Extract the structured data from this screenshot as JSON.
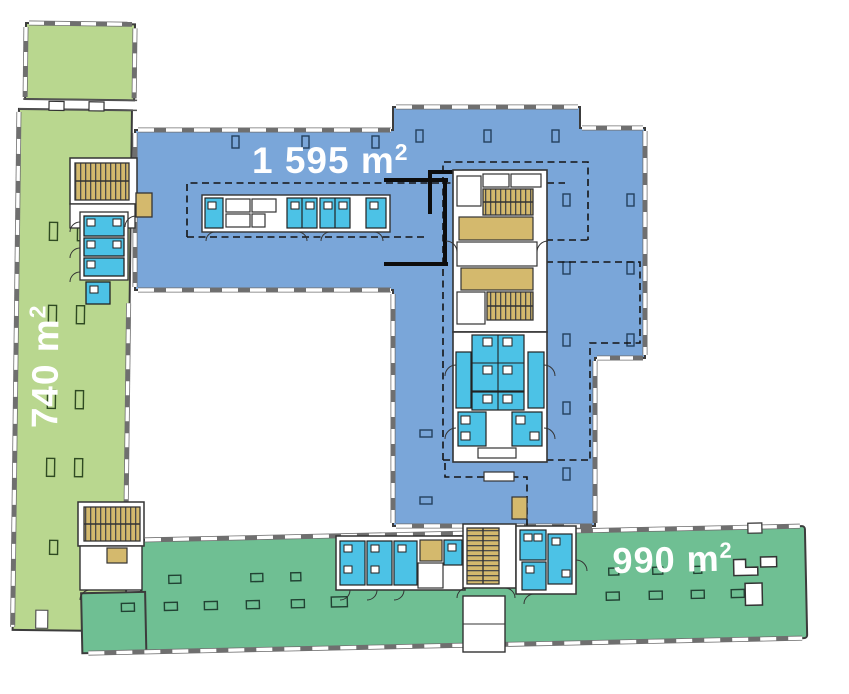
{
  "page": {
    "title": "Office floor plan with rentable areas"
  },
  "zones": {
    "left_wing": {
      "area_label": "740 m²",
      "value_unit": "740 m",
      "sup": "2",
      "color": "#b9d78f"
    },
    "main": {
      "area_label": "1 595 m²",
      "value_unit": "1 595 m",
      "sup": "2",
      "color": "#7aa6d9"
    },
    "bottom_wing": {
      "area_label": "990 m²",
      "value_unit": "990 m",
      "sup": "2",
      "color": "#6fbf93"
    }
  },
  "palette": {
    "wet_rooms": "#4cc2e6",
    "stairs": "#d4b96d",
    "walls": "#3c3c3c",
    "label_text": "#ffffff"
  }
}
